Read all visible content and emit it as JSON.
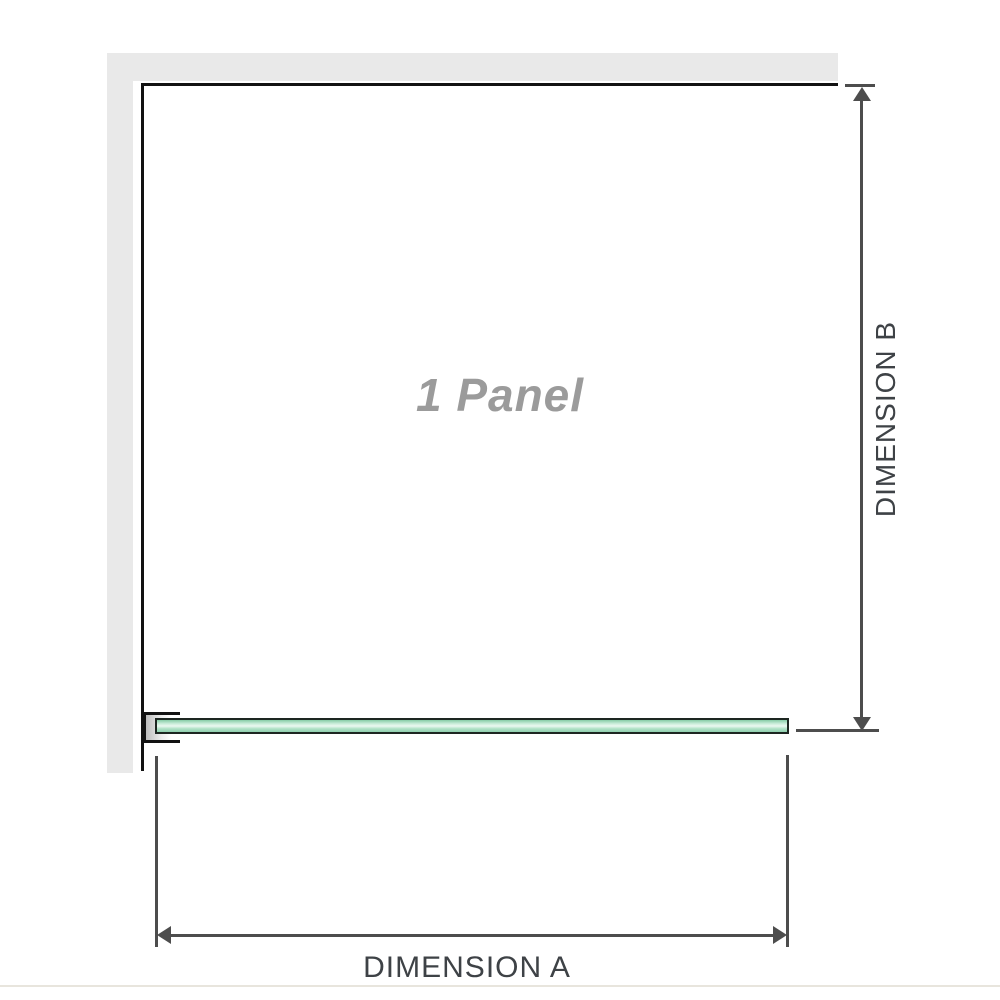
{
  "diagram": {
    "panel_label": "1 Panel",
    "dimensions": {
      "a_label": "DIMENSION A",
      "b_label": "DIMENSION B"
    },
    "colors": {
      "wall": "#e9e9e9",
      "panel_border": "#121212",
      "glass_fill": "#a9dec4",
      "glass_highlight": "#ecf9f1",
      "glass_border": "#1d2621",
      "bracket_border": "#121212",
      "dimension_line": "#4d4d4d",
      "dimension_text": "#3e4246",
      "panel_label_text": "#9b9b9b",
      "bottom_divider": "#e8e5dd"
    }
  }
}
